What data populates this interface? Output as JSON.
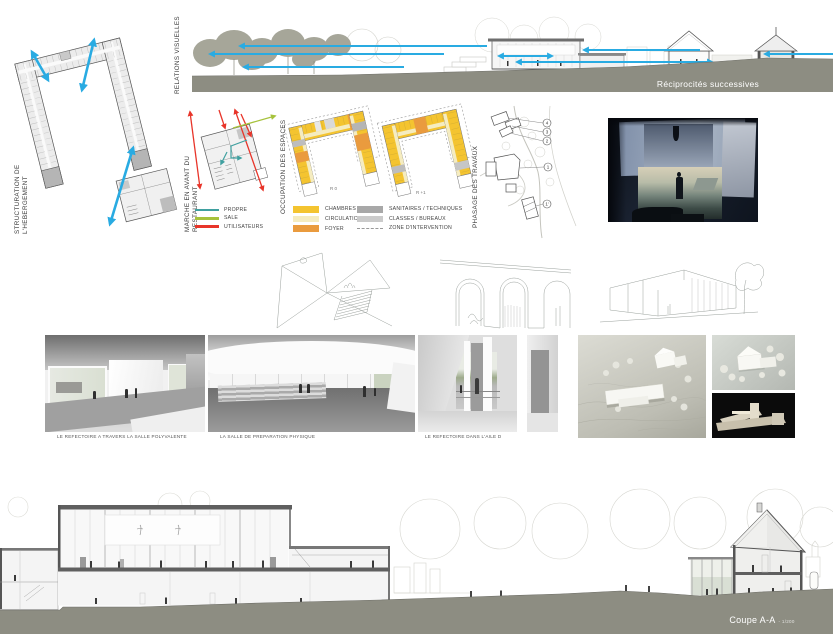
{
  "board": {
    "accent_blue": "#29ABE2",
    "ground_color": "#8D8D82",
    "tree_color": "#A6A699"
  },
  "titles": {
    "structuration": "STRUCTURATION DE L'HEBERGEMENT",
    "relations_visuelles": "RELATIONS VISUELLES",
    "reciprocites": "Réciprocités successives",
    "marche_avant": "MARCHE EN AVANT DU RESTAURANT",
    "occupation": "OCCUPATION DES ESPACES",
    "phasage": "PHASAGE DES TRAVAUX"
  },
  "legend_flux": {
    "items": [
      {
        "label": "PROPRE",
        "color": "#3FA0A0"
      },
      {
        "label": "SALE",
        "color": "#A6C23C"
      },
      {
        "label": "UTILISATEURS",
        "color": "#E8352A"
      }
    ]
  },
  "legend_espaces": {
    "left": [
      {
        "label": "CHAMBRES",
        "color": "#F4C430"
      },
      {
        "label": "CIRCULATION",
        "color": "#F5ECC0"
      },
      {
        "label": "FOYER",
        "color": "#EA9B3E"
      }
    ],
    "right": [
      {
        "label": "SANITAIRES / TECHNIQUES",
        "color": "#A8A8A8"
      },
      {
        "label": "CLASSES / BUREAUX",
        "color": "#CBCBCB"
      },
      {
        "label": "ZONE D'INTERVENTION",
        "color": "dashed"
      }
    ]
  },
  "levels": {
    "left": "R 0",
    "right": "R +1"
  },
  "phase_markers": {
    "p4": "4",
    "p3": "3",
    "p2": "2",
    "p1": "1",
    "p1b": "1'"
  },
  "captions": {
    "render1": "LE REFECTOIRE A TRAVERS LA SALLE POLYVALENTE",
    "render2": "LA SALLE DE PREPARATION PHYSIQUE",
    "render3": "LE REFECTOIRE DANS L'AILE D"
  },
  "coupe": {
    "label": "Coupe A-A",
    "scale": "- 1/200"
  }
}
